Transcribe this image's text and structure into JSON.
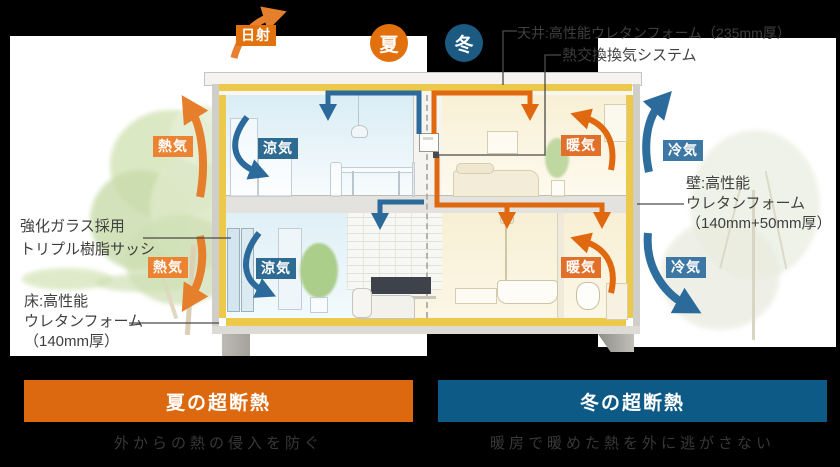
{
  "legend": {
    "solar": "日射",
    "summer_circle": "夏",
    "winter_circle": "冬"
  },
  "air_labels": {
    "hot": "熱気",
    "cool": "涼気",
    "warm": "暖気",
    "cold": "冷気"
  },
  "annotations": {
    "ceiling": "天井:高性能ウレタンフォーム（235mm厚）",
    "ventilation": "熱交換換気システム",
    "window_line1": "強化ガラス採用",
    "window_line2": "トリプル樹脂サッシ",
    "floor_line1": "床:高性能",
    "floor_line2": "ウレタンフォーム",
    "floor_line3": "（140mm厚）",
    "wall_line1": "壁:高性能",
    "wall_line2": "ウレタンフォーム",
    "wall_line3": "（140mm+50mm厚）"
  },
  "banners": {
    "summer": {
      "title": "夏の超断熱",
      "caption": "外からの熱の侵入を防ぐ"
    },
    "winter": {
      "title": "冬の超断熱",
      "caption": "暖房で暖めた熱を外に逃がさない"
    }
  },
  "colors": {
    "summer_accent": "#dc690f",
    "winter_accent": "#0e5a86",
    "insulation_yellow": "#ecc94b",
    "hot_air_orange": "#e57f2b",
    "cool_air_blue": "#2b6a9b",
    "warm_label_orange": "#e1702b",
    "cold_label_blue": "#3d77a3"
  }
}
